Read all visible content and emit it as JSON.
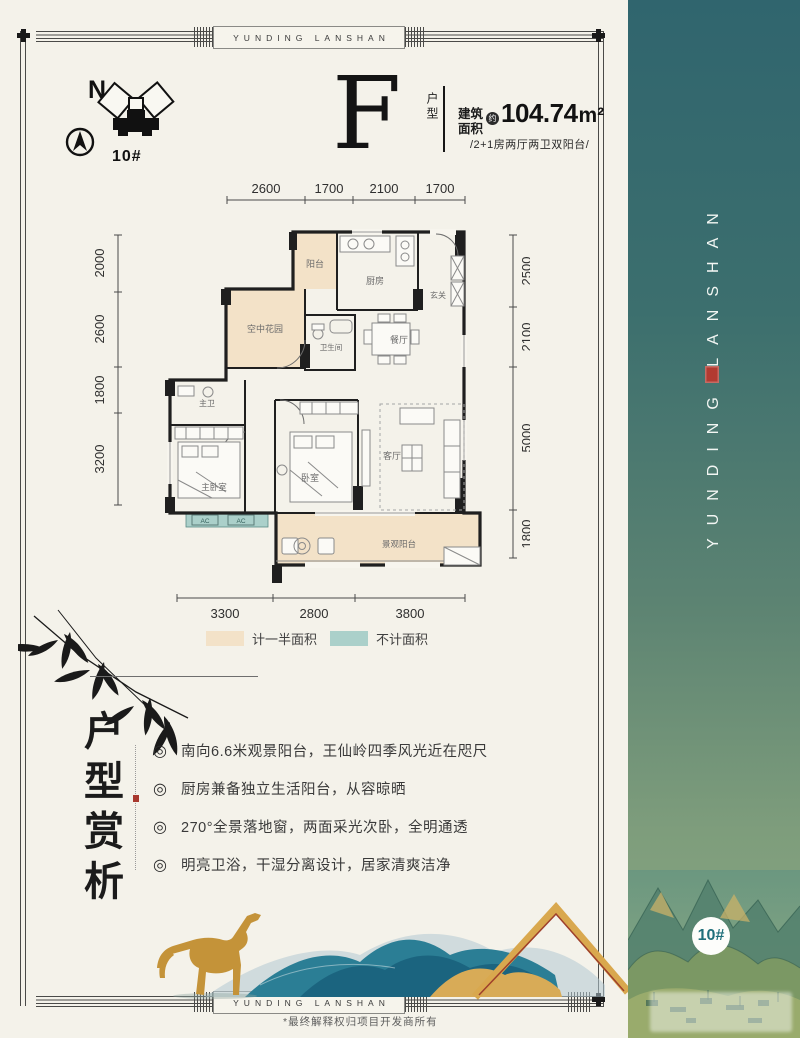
{
  "frame": {
    "banner_top": "YUNDING LANSHAN",
    "banner_bottom": "YUNDING LANSHAN",
    "footer_note": "*最终解释权归项目开发商所有"
  },
  "compass": {
    "north_label": "N",
    "building_no": "10#"
  },
  "unit": {
    "letter": "F",
    "type_label": "户型",
    "area_label_1": "建筑",
    "area_label_2": "面积",
    "area_about": "约",
    "area_value": "104.74",
    "area_unit": "m²",
    "layout_desc": "/2+1房两厅两卫双阳台/"
  },
  "plan": {
    "dims_top": [
      "2600",
      "1700",
      "2100",
      "1700"
    ],
    "dims_left": [
      "2000",
      "2600",
      "1800",
      "3200"
    ],
    "dims_right": [
      "2500",
      "2100",
      "5000",
      "1800"
    ],
    "dims_bottom": [
      "3300",
      "2800",
      "3800"
    ],
    "rooms": {
      "balcony": "阳台",
      "kitchen": "厨房",
      "foyer": "玄关",
      "sky_garden": "空中花园",
      "bathroom": "卫生间",
      "dining": "餐厅",
      "master_bath": "主卫",
      "master_bedroom": "主卧室",
      "bedroom": "卧室",
      "living_room": "客厅",
      "view_balcony": "景观阳台",
      "ac_unit": "AC"
    },
    "legend": {
      "half_area": {
        "label": "计一半面积",
        "color": "#f3e2c8"
      },
      "excluded_area": {
        "label": "不计面积",
        "color": "#abd0ca"
      }
    }
  },
  "highlights": {
    "title": "户型赏析",
    "title_chars": [
      "户",
      "型",
      "赏",
      "析"
    ],
    "bullet_marker": "◎",
    "bullets": [
      "南向6.6米观景阳台，王仙岭四季风光近在咫尺",
      "厨房兼备独立生活阳台，从容晾晒",
      "270°全景落地窗，两面采光次卧，全明通透",
      "明亮卫浴，干湿分离设计，居家清爽洁净"
    ]
  },
  "side_band": {
    "vertical_text": "YUNDING LANSHAN",
    "badge": "10#",
    "gradient_top": "#30656e",
    "gradient_bottom": "#8aa983"
  },
  "colors": {
    "paper": "#f4f2ea",
    "wall": "#1f1f1f",
    "beige_fill": "#f3e2c8",
    "teal_fill": "#abd0ca",
    "gold": "#d9a84e",
    "seal_red": "#b23a31",
    "badge_text": "#1f6f7b"
  }
}
